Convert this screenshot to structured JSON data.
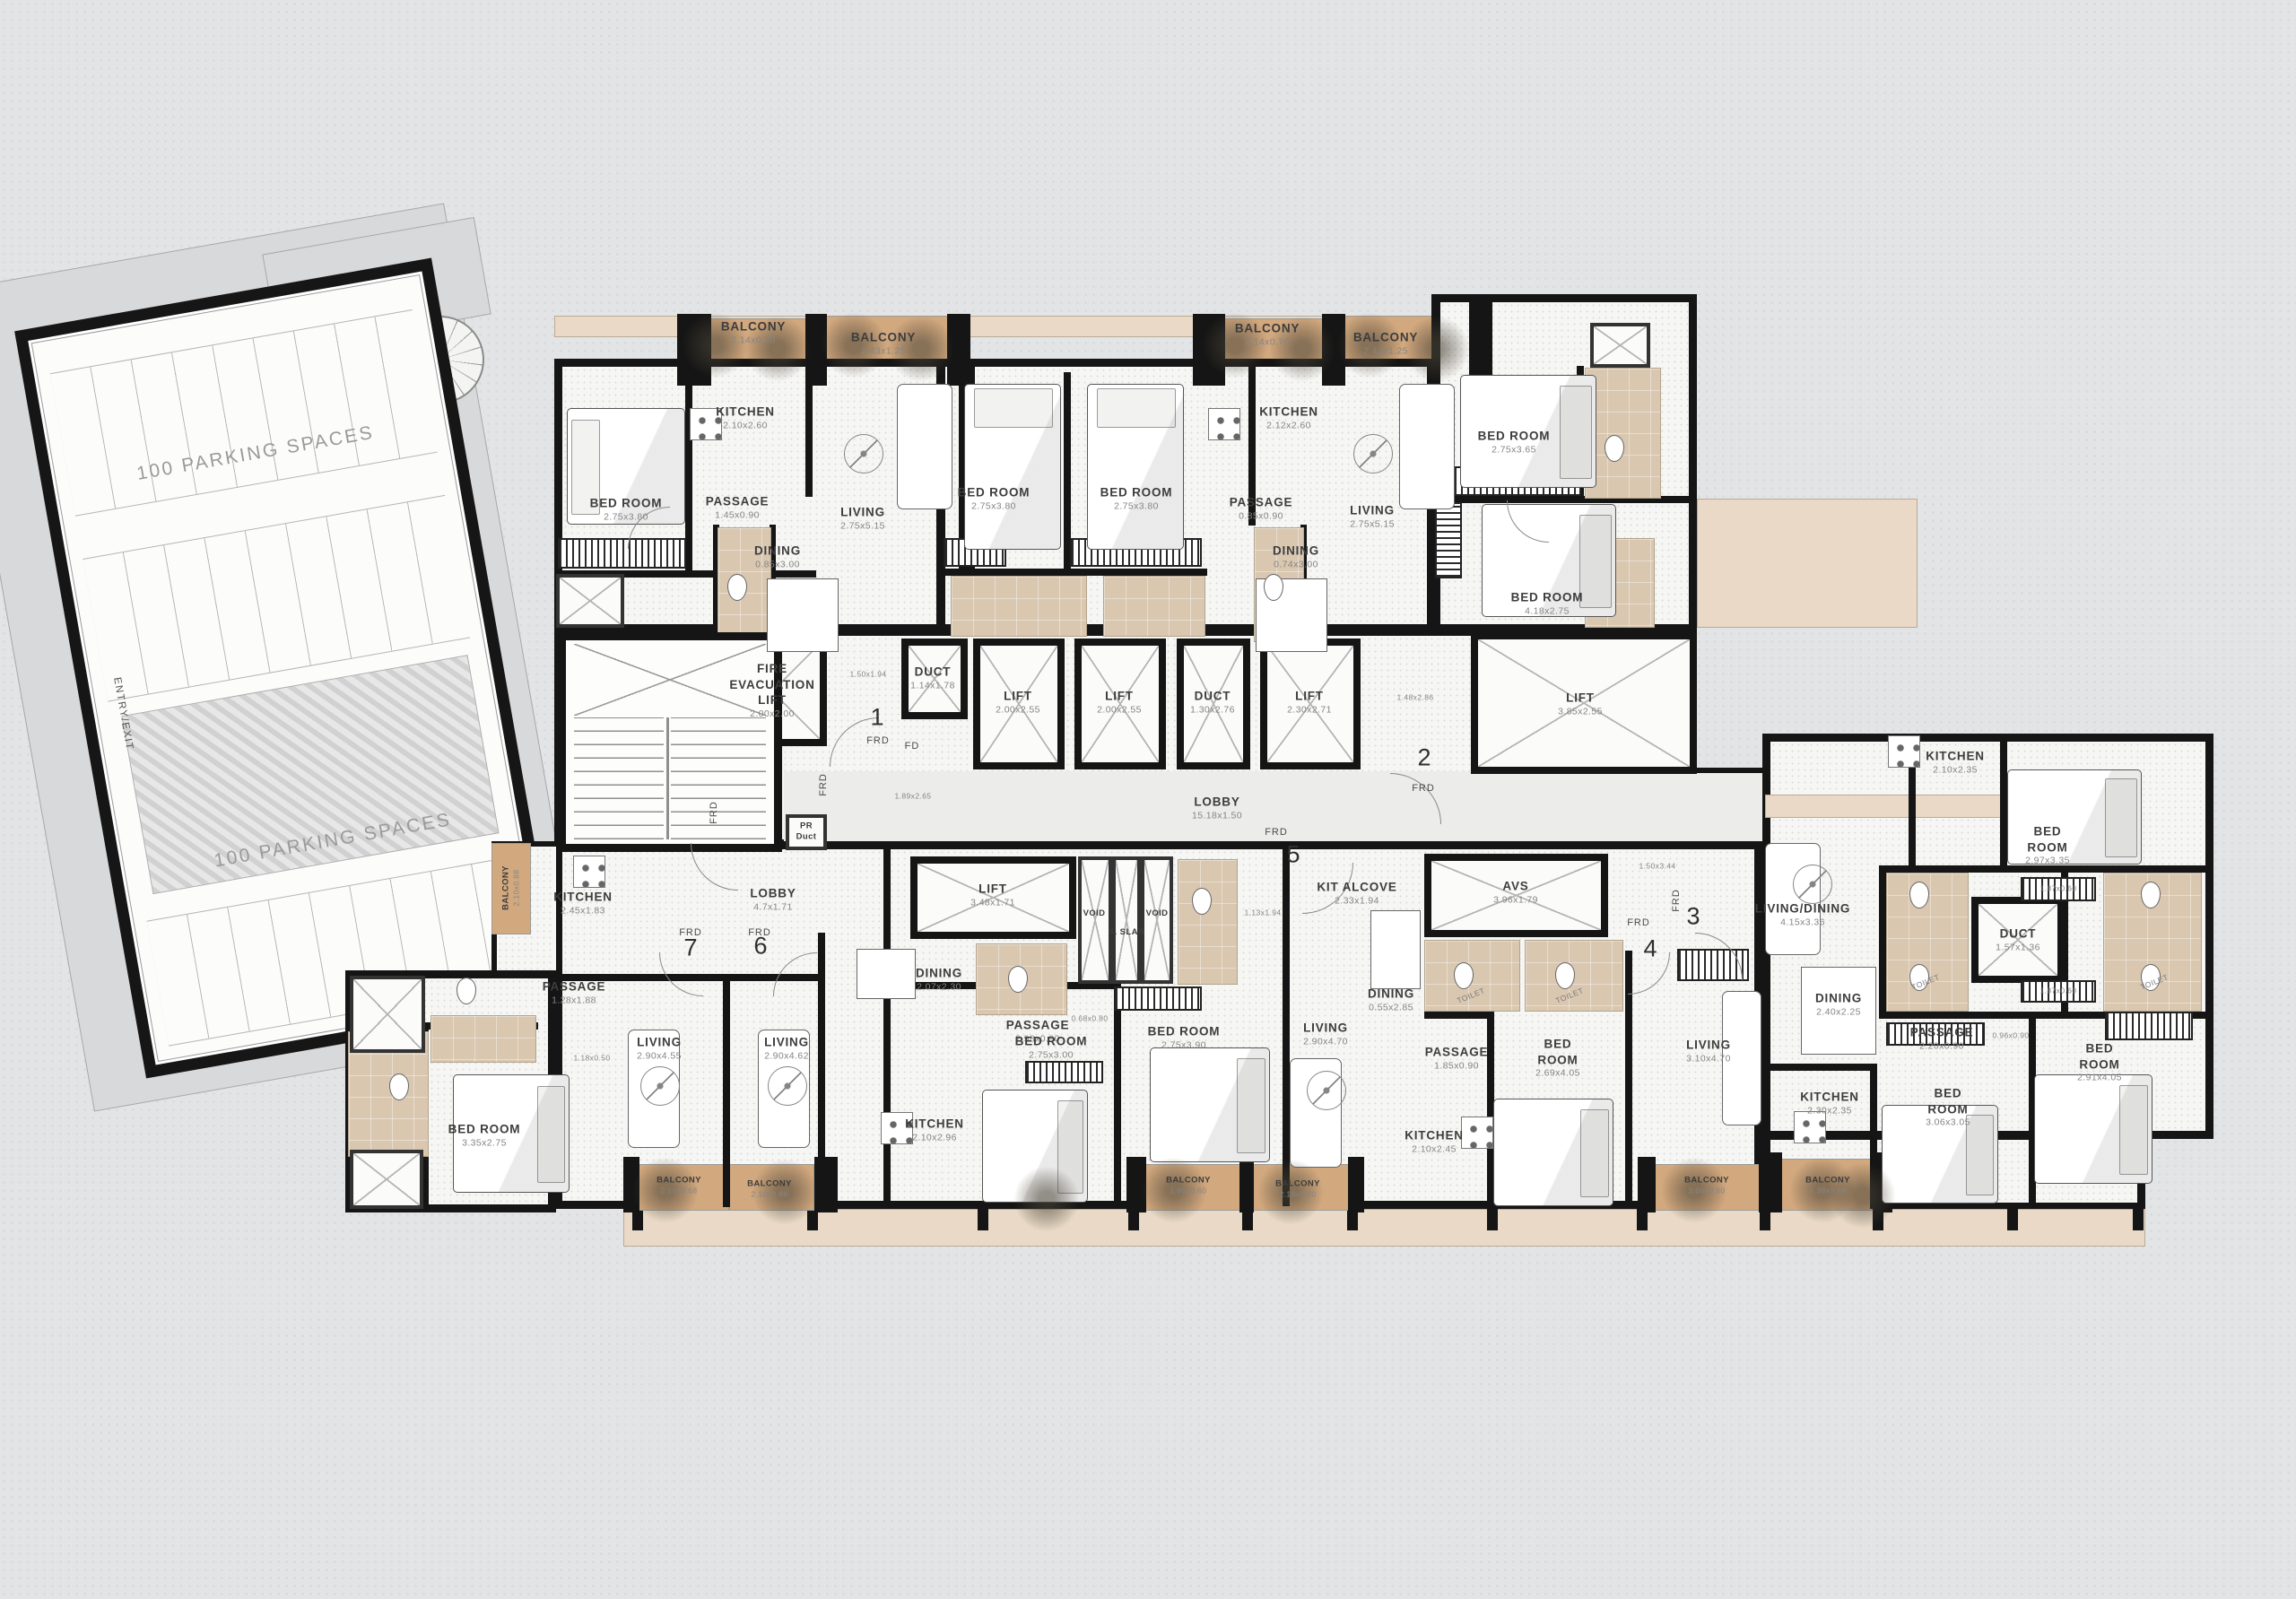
{
  "parking": {
    "spaces_label_1": "100 PARKING SPACES",
    "spaces_label_2": "100 PARKING SPACES",
    "entry_exit_label": "ENTRY/EXIT"
  },
  "strings": {
    "frd": "FRD",
    "fd": "FD",
    "toilet": "TOILET",
    "pr_duct_line1": "PR",
    "pr_duct_line2": "Duct"
  },
  "unit_numbers": [
    "1",
    "2",
    "3",
    "4",
    "5",
    "6",
    "7"
  ],
  "colors": {
    "wall": "#151515",
    "balcony": "#d2a87e",
    "tile": "#d9c7b0",
    "wood": "#e9d9c6",
    "background": "#e3e4e6"
  },
  "rooms": [
    {
      "name": "BALCONY",
      "dims": "2.14x0.70"
    },
    {
      "name": "BALCONY",
      "dims": "2.43x1.25"
    },
    {
      "name": "KITCHEN",
      "dims": "2.10x2.60"
    },
    {
      "name": "BED ROOM",
      "dims": "2.75x3.80"
    },
    {
      "name": "PASSAGE",
      "dims": "1.45x0.90"
    },
    {
      "name": "LIVING",
      "dims": "2.75x5.15"
    },
    {
      "name": "DINING",
      "dims": "0.85x3.00"
    },
    {
      "name": "BED ROOM",
      "dims": "2.75x3.80"
    },
    {
      "name": "BED ROOM",
      "dims": "2.75x3.80"
    },
    {
      "name": "BALCONY",
      "dims": "2.14x0.70"
    },
    {
      "name": "BALCONY",
      "dims": "2.43x1.25"
    },
    {
      "name": "KITCHEN",
      "dims": "2.12x2.60"
    },
    {
      "name": "PASSAGE",
      "dims": "0.85x0.90"
    },
    {
      "name": "DINING",
      "dims": "0.74x3.00"
    },
    {
      "name": "LIVING",
      "dims": "2.75x5.15"
    },
    {
      "name": "BED ROOM",
      "dims": "2.75x3.65"
    },
    {
      "name": "BED ROOM",
      "dims": "4.18x2.75"
    },
    {
      "name": "FIRE EVACUATION LIFT",
      "dims": "2.00x2.00"
    },
    {
      "name": "DUCT",
      "dims": "1.14x1.78"
    },
    {
      "name": "",
      "dims": "1.50x1.94"
    },
    {
      "name": "LIFT",
      "dims": "2.00x2.55"
    },
    {
      "name": "LIFT",
      "dims": "2.00x2.55"
    },
    {
      "name": "DUCT",
      "dims": "1.30x2.76"
    },
    {
      "name": "LIFT",
      "dims": "2.30x2.71"
    },
    {
      "name": "",
      "dims": "1.48x2.86"
    },
    {
      "name": "LIFT",
      "dims": "3.85x2.55"
    },
    {
      "name": "LOBBY",
      "dims": "15.18x1.50"
    },
    {
      "name": "",
      "dims": "1.89x2.65"
    },
    {
      "name": "",
      "dims": "1.50x3.44"
    },
    {
      "name": "KIT ALCOVE",
      "dims": "2.33x1.94"
    },
    {
      "name": "AVS",
      "dims": "3.96x1.79"
    },
    {
      "name": "VOID",
      "dims": ""
    },
    {
      "name": "S. SLAB",
      "dims": ""
    },
    {
      "name": "VOID",
      "dims": ""
    },
    {
      "name": "LIFT",
      "dims": "3.48x1.71"
    },
    {
      "name": "",
      "dims": "1.13x1.94"
    },
    {
      "name": "LOBBY",
      "dims": "4.7x1.71"
    },
    {
      "name": "KITCHEN",
      "dims": "2.45x1.83"
    },
    {
      "name": "BALCONY",
      "dims": "2.10x0.88"
    },
    {
      "name": "PASSAGE",
      "dims": "1.28x1.88"
    },
    {
      "name": "",
      "dims": "1.18x0.50"
    },
    {
      "name": "BED ROOM",
      "dims": "3.35x2.75"
    },
    {
      "name": "LIVING",
      "dims": "2.90x4.55"
    },
    {
      "name": "LIVING",
      "dims": "2.90x4.62"
    },
    {
      "name": "BALCONY",
      "dims": "2.10x0.68"
    },
    {
      "name": "BALCONY",
      "dims": "2.10x0.88"
    },
    {
      "name": "DINING",
      "dims": "2.07x2.30"
    },
    {
      "name": "PASSAGE",
      "dims": "2.98x0.90"
    },
    {
      "name": "",
      "dims": "0.68x0.80"
    },
    {
      "name": "KITCHEN",
      "dims": "2.10x2.96"
    },
    {
      "name": "BED ROOM",
      "dims": "2.75x3.00"
    },
    {
      "name": "BED ROOM",
      "dims": "2.75x3.90"
    },
    {
      "name": "BALCONY",
      "dims": "1.95x0.60"
    },
    {
      "name": "BALCONY",
      "dims": "2.10x0.60"
    },
    {
      "name": "LIVING",
      "dims": "2.90x4.70"
    },
    {
      "name": "DINING",
      "dims": "0.55x2.85"
    },
    {
      "name": "PASSAGE",
      "dims": "1.85x0.90"
    },
    {
      "name": "KITCHEN",
      "dims": "2.10x2.45"
    },
    {
      "name": "BED ROOM",
      "dims": "2.69x4.05"
    },
    {
      "name": "LIVING",
      "dims": "3.10x4.70"
    },
    {
      "name": "BALCONY",
      "dims": "3.08x0.60"
    },
    {
      "name": "KITCHEN",
      "dims": "2.10x2.35"
    },
    {
      "name": "BED ROOM",
      "dims": "2.97x3.35"
    },
    {
      "name": "LIVING/DINING",
      "dims": "4.15x3.36"
    },
    {
      "name": "DUCT",
      "dims": "1.57x1.36"
    },
    {
      "name": "DINING",
      "dims": "2.40x2.25"
    },
    {
      "name": "PASSAGE",
      "dims": "2.20x0.90"
    },
    {
      "name": "",
      "dims": "0.96x0.90"
    },
    {
      "name": "KITCHEN",
      "dims": "2.30x2.35"
    },
    {
      "name": "BED ROOM",
      "dims": "3.06x3.05"
    },
    {
      "name": "BED ROOM",
      "dims": "2.91x4.05"
    },
    {
      "name": "BALCONY",
      "dims": "1.38x0.68"
    },
    {
      "name": "",
      "dims": "1.87x0.60"
    },
    {
      "name": "",
      "dims": "1.87x0.60"
    }
  ]
}
